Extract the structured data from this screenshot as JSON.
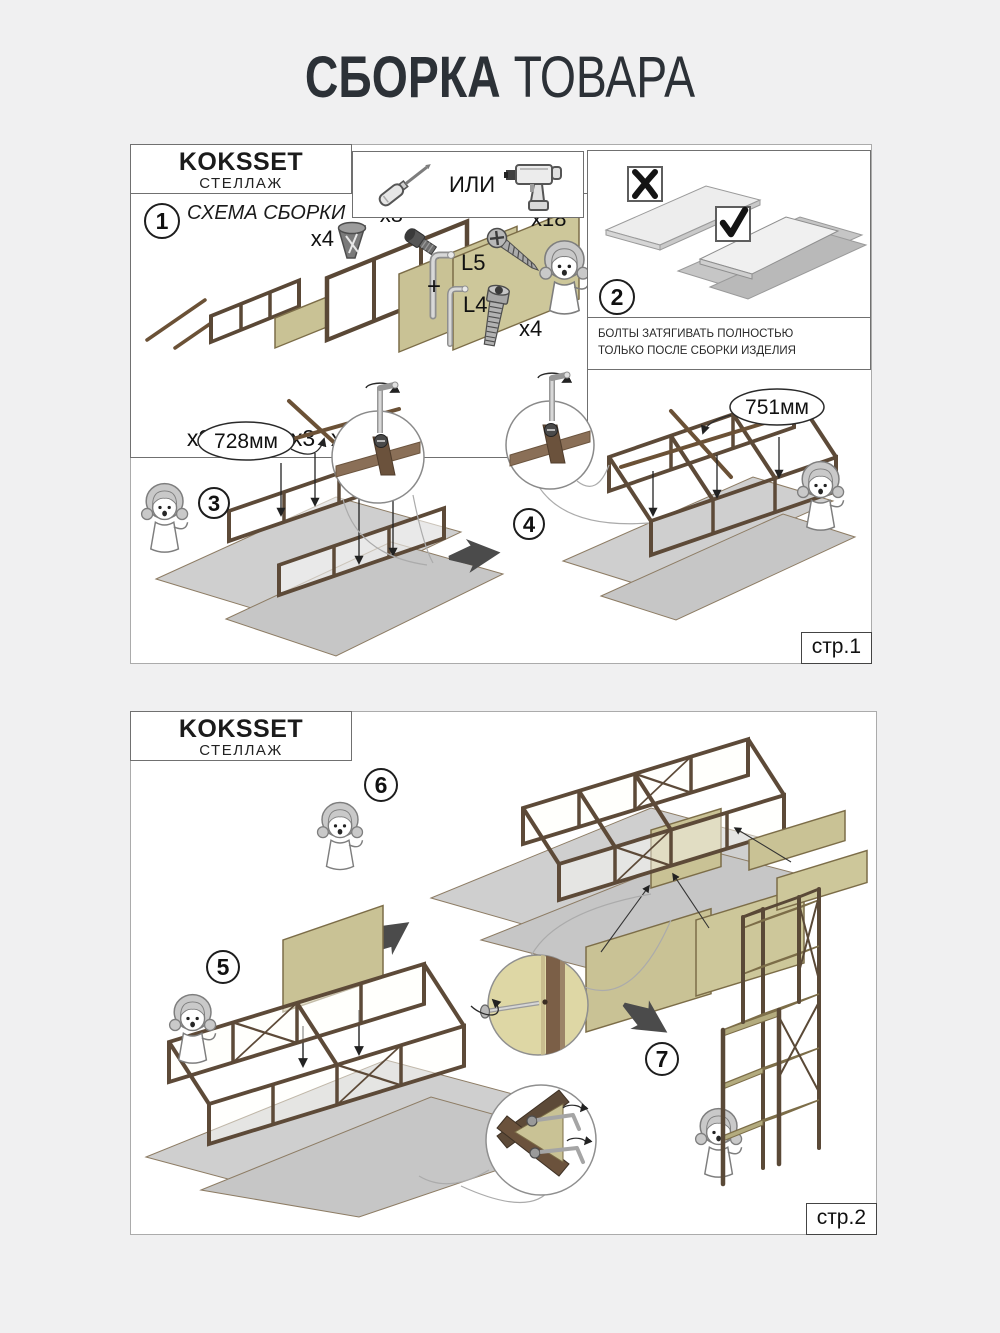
{
  "title": {
    "bold": "СБОРКА",
    "light": "ТОВАРА"
  },
  "sheet1": {
    "brand": "KOKSSET",
    "type": "СТЕЛЛАЖ",
    "tools": {
      "or_label": "ИЛИ"
    },
    "step1": {
      "number": "1",
      "heading": "СХЕМА СБОРКИ",
      "counts": [
        "x2",
        "x2",
        "x2",
        "x3",
        "x2",
        "x2"
      ],
      "hardware": {
        "foot_qty": "x4",
        "bolt_qty": "x8",
        "key_big": "L5",
        "plus": "+",
        "key_small": "L4",
        "screw_qty": "x18",
        "big_bolt_qty": "x4"
      }
    },
    "step2": {
      "number": "2"
    },
    "note": {
      "line1": "БОЛТЫ ЗАТЯГИВАТЬ ПОЛНОСТЬЮ",
      "line2": "ТОЛЬКО ПОСЛЕ СБОРКИ ИЗДЕЛИЯ"
    },
    "step3": {
      "number": "3",
      "dim": "728мм"
    },
    "step4": {
      "number": "4",
      "dim": "751мм"
    },
    "page_label": "стр.1"
  },
  "sheet2": {
    "brand": "KOKSSET",
    "type": "СТЕЛЛАЖ",
    "step5": {
      "number": "5"
    },
    "step6": {
      "number": "6"
    },
    "step7": {
      "number": "7"
    },
    "page_label": "стр.2"
  },
  "colors": {
    "accent_frame_brown": "#5d4a38",
    "panel_khaki": "#c9c295",
    "cardboard_gray": "#cfcfcf",
    "arrow_dark": "#4b4b4b",
    "background": "#f0f0f1"
  }
}
